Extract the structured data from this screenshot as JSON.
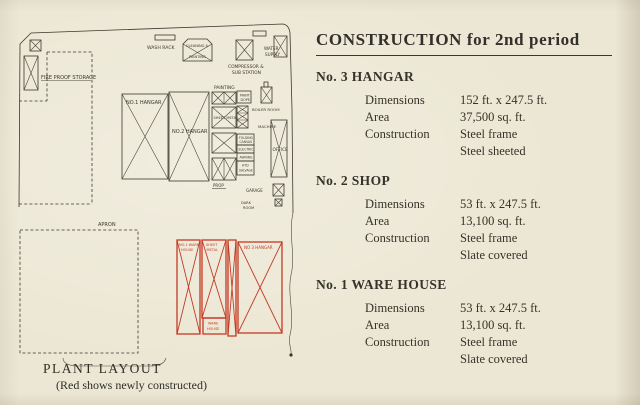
{
  "header": {
    "title": "CONSTRUCTION for 2nd period"
  },
  "specs": {
    "sections": [
      {
        "heading": "No. 3 HANGAR",
        "rows": [
          {
            "label": "Dimensions",
            "value": "152 ft. x 247.5 ft."
          },
          {
            "label": "Area",
            "value": "37,500 sq. ft."
          },
          {
            "label": "Construction",
            "value": "Steel frame"
          },
          {
            "label": "",
            "value": "Steel sheeted"
          }
        ]
      },
      {
        "heading": "No. 2 SHOP",
        "rows": [
          {
            "label": "Dimensions",
            "value": "53 ft. x 247.5 ft."
          },
          {
            "label": "Area",
            "value": "13,100 sq. ft."
          },
          {
            "label": "Construction",
            "value": "Steel frame"
          },
          {
            "label": "",
            "value": "Slate covered"
          }
        ]
      },
      {
        "heading": "No. 1 WARE HOUSE",
        "rows": [
          {
            "label": "Dimensions",
            "value": "53 ft. x 247.5 ft."
          },
          {
            "label": "Area",
            "value": "13,100 sq. ft."
          },
          {
            "label": "Construction",
            "value": "Steel frame"
          },
          {
            "label": "",
            "value": "Slate covered"
          }
        ]
      }
    ]
  },
  "plan": {
    "caption": "PLANT LAYOUT",
    "caption_note": "(Red shows newly constructed)",
    "ink_color": "#3a382e",
    "red_color": "#c43a26",
    "labels": {
      "wash_rack": "WASH RACK",
      "cleaning_l1": "CLEANING &",
      "cleaning_l2": "PAINTING",
      "compressor_l1": "COMPRESSOR &",
      "compressor_l2": "SUB STATION",
      "water_l1": "WATER",
      "water_l2": "SUPPLY",
      "fire_proof": "FIRE PROOF STORAGE",
      "no1_hangar": "NO.1 HANGAR",
      "no2_hangar": "NO.2 HANGAR",
      "painting": "PAINTING",
      "dope_l1": "PAINT",
      "dope_l2": "DOPE",
      "sheet_metal": "SHEET METAL",
      "boiler": "BOILER ROOM",
      "machine": "MACHINE",
      "office": "OFFICE",
      "stack1_l1": "FOLDING",
      "stack1_l2": "CANVAS",
      "stack2": "ELECTRIC",
      "stack3": "AWNING",
      "stack4_l1": "HYD",
      "stack4_l2": "SALVAGE",
      "prop": "PROP",
      "garage": "GARAGE",
      "dark_l1": "DARK",
      "dark_l2": "ROOM",
      "apron": "APRON",
      "red_no1_l1": "NO.1 WARE",
      "red_no1_l2": "HOUSE",
      "red_sm_l1": "SHEET",
      "red_sm_l2": "METAL",
      "red_no3": "NO 3 HANGAR",
      "red_wh_l1": "WARE",
      "red_wh_l2": "HOUSE"
    }
  }
}
